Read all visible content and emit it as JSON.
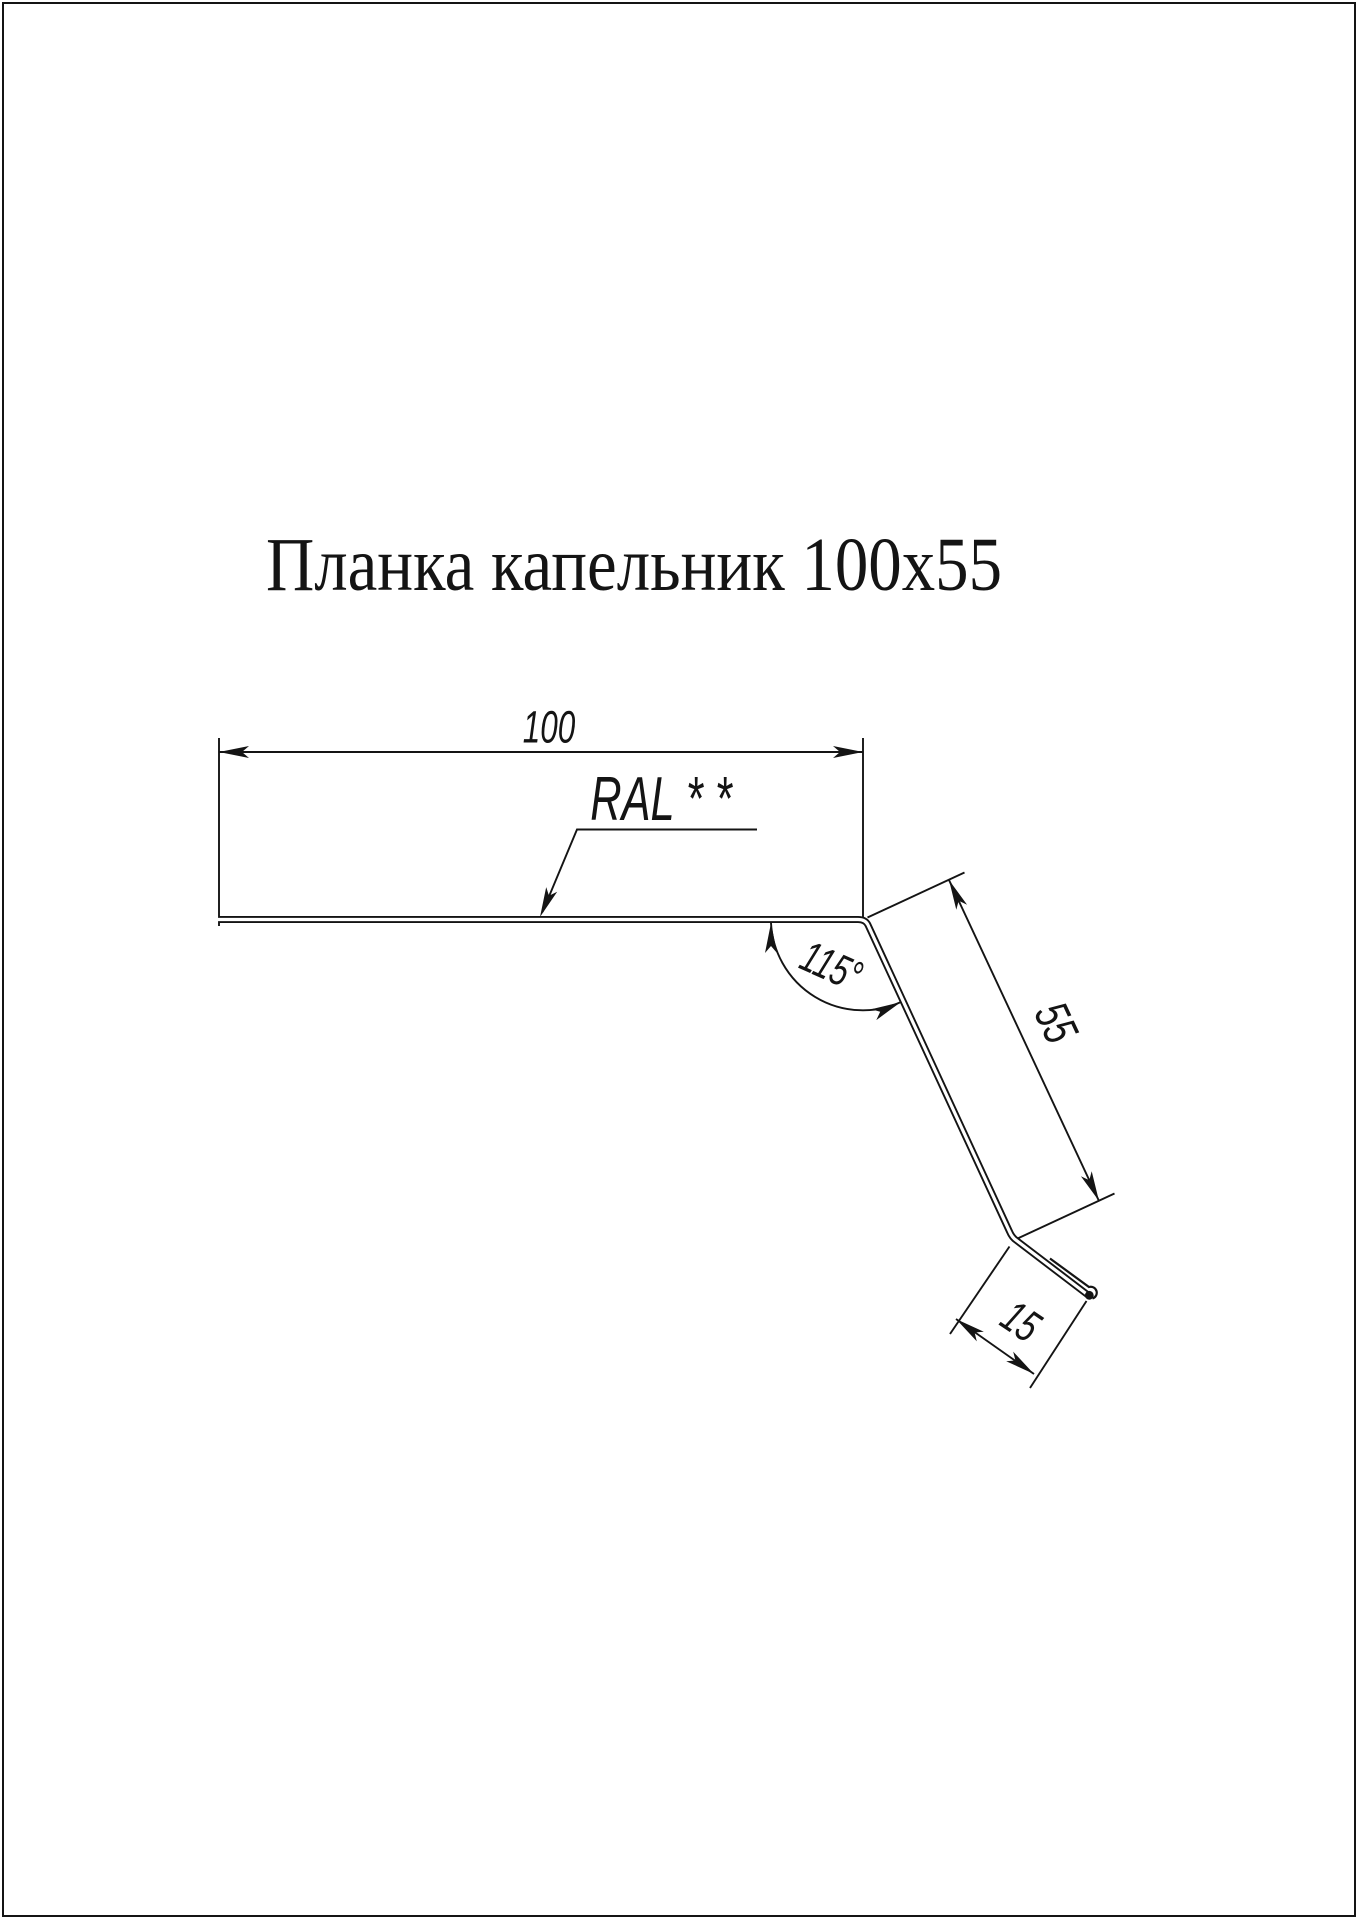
{
  "title": "Планка капельник 100х55",
  "labels": {
    "width": "100",
    "coating": "RAL * *",
    "angle": "115°",
    "side": "55",
    "kick": "15"
  },
  "colors": {
    "background": "#ffffff",
    "line": "#141414"
  }
}
